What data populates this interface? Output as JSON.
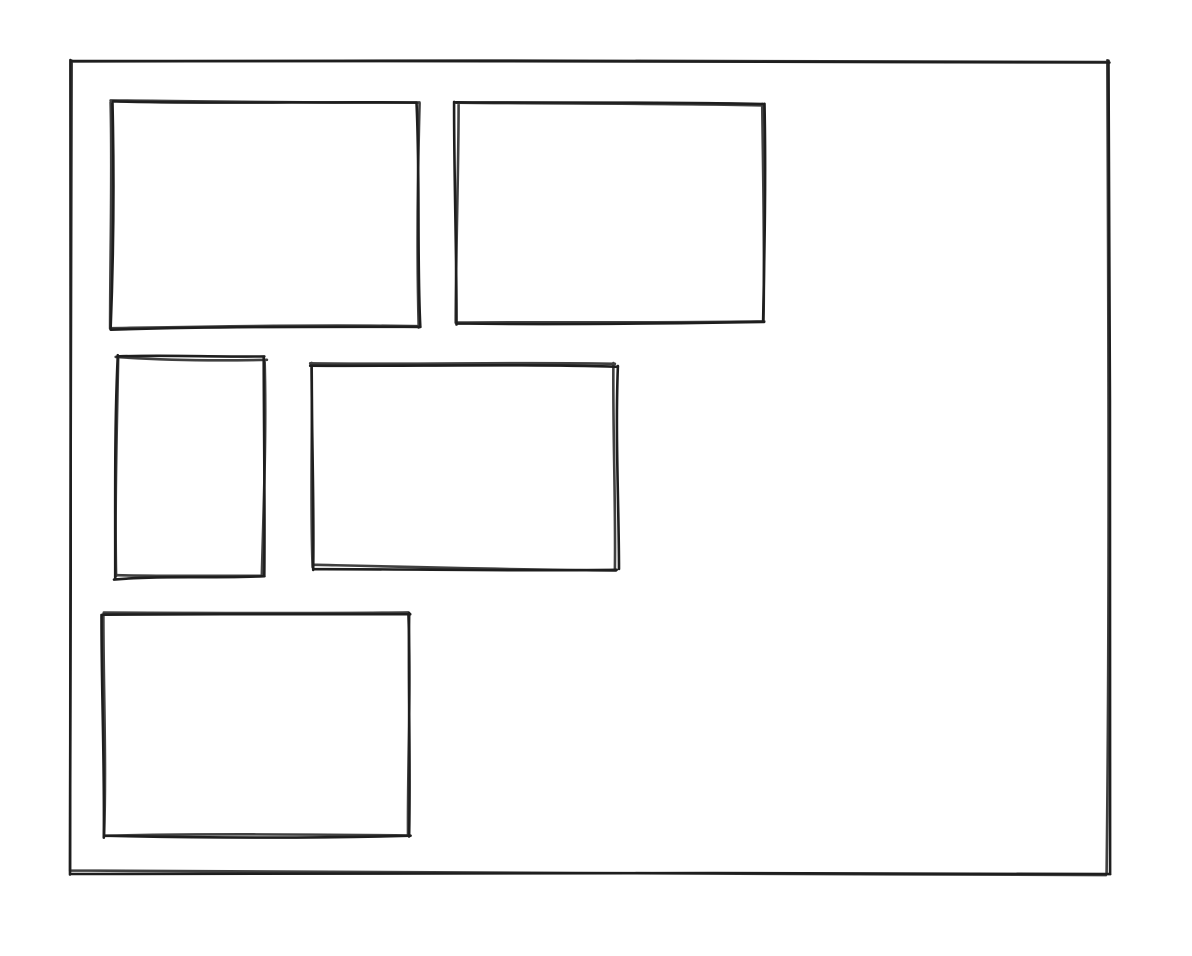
{
  "app": {
    "kind": "whiteboard-sketch",
    "background_color": "#ffffff"
  },
  "sketch": {
    "stroke_color": "#1e1e1e",
    "stroke_width": 2.6,
    "fill": "none",
    "style": "hand-drawn",
    "shapes": [
      {
        "name": "outer-frame-rect",
        "x": 71,
        "y": 61,
        "width": 1038,
        "height": 812
      },
      {
        "name": "top-left-rect",
        "x": 111,
        "y": 103,
        "width": 307,
        "height": 224
      },
      {
        "name": "top-right-rect",
        "x": 457,
        "y": 104,
        "width": 306,
        "height": 218
      },
      {
        "name": "middle-left-rect",
        "x": 115,
        "y": 358,
        "width": 149,
        "height": 219
      },
      {
        "name": "middle-right-rect",
        "x": 311,
        "y": 365,
        "width": 305,
        "height": 203
      },
      {
        "name": "bottom-left-rect",
        "x": 103,
        "y": 613,
        "width": 307,
        "height": 223
      }
    ]
  }
}
